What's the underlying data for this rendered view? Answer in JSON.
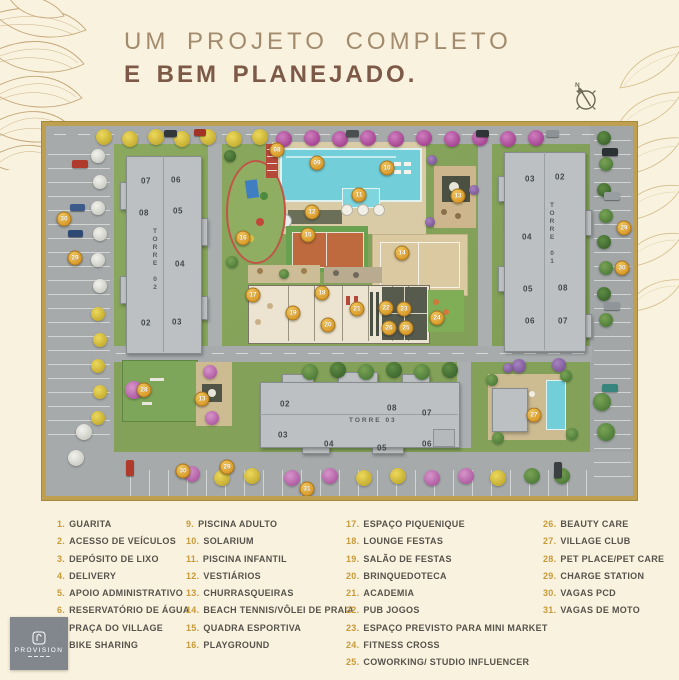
{
  "title": {
    "line1": "UM PROJETO COMPLETO",
    "line2": "E BEM PLANEJADO."
  },
  "compass": {
    "north_label": "N"
  },
  "watermark": {
    "text": "PROVISION"
  },
  "colors": {
    "accent_gold": "#bfa050",
    "marker": "#d99a2b",
    "title_light": "#a38b6e",
    "title_dark": "#7d5948",
    "grass": "#8aa75e",
    "road": "#a6aaab",
    "pool": "#72ced8",
    "legend_number": "#c79a3a",
    "legend_text": "#56524c"
  },
  "map": {
    "tower_labels": [
      {
        "text": "TORRE 02",
        "x": 109,
        "y": 102,
        "vertical": true
      },
      {
        "text": "TORRE 01",
        "x": 506,
        "y": 76,
        "vertical": true
      },
      {
        "text": "TORRE 03",
        "x": 303,
        "y": 291,
        "vertical": false
      }
    ],
    "unit_labels": [
      {
        "text": "07",
        "x": 100,
        "y": 55
      },
      {
        "text": "06",
        "x": 130,
        "y": 54
      },
      {
        "text": "08",
        "x": 98,
        "y": 87
      },
      {
        "text": "05",
        "x": 132,
        "y": 85
      },
      {
        "text": "04",
        "x": 134,
        "y": 138
      },
      {
        "text": "02",
        "x": 100,
        "y": 197
      },
      {
        "text": "03",
        "x": 131,
        "y": 196
      },
      {
        "text": "03",
        "x": 484,
        "y": 53
      },
      {
        "text": "02",
        "x": 514,
        "y": 51
      },
      {
        "text": "04",
        "x": 481,
        "y": 111
      },
      {
        "text": "05",
        "x": 482,
        "y": 163
      },
      {
        "text": "08",
        "x": 517,
        "y": 162
      },
      {
        "text": "06",
        "x": 484,
        "y": 195
      },
      {
        "text": "07",
        "x": 517,
        "y": 195
      },
      {
        "text": "02",
        "x": 239,
        "y": 278
      },
      {
        "text": "03",
        "x": 237,
        "y": 309
      },
      {
        "text": "04",
        "x": 283,
        "y": 318
      },
      {
        "text": "05",
        "x": 336,
        "y": 322
      },
      {
        "text": "06",
        "x": 381,
        "y": 318
      },
      {
        "text": "07",
        "x": 381,
        "y": 287
      },
      {
        "text": "08",
        "x": 346,
        "y": 282
      }
    ],
    "markers": [
      {
        "n": "08",
        "x": 231,
        "y": 24
      },
      {
        "n": "09",
        "x": 271,
        "y": 37
      },
      {
        "n": "10",
        "x": 341,
        "y": 42
      },
      {
        "n": "11",
        "x": 313,
        "y": 69
      },
      {
        "n": "12",
        "x": 266,
        "y": 86
      },
      {
        "n": "13",
        "x": 412,
        "y": 70
      },
      {
        "n": "14",
        "x": 356,
        "y": 127
      },
      {
        "n": "15",
        "x": 262,
        "y": 109
      },
      {
        "n": "16",
        "x": 197,
        "y": 112
      },
      {
        "n": "17",
        "x": 207,
        "y": 169
      },
      {
        "n": "18",
        "x": 276,
        "y": 167
      },
      {
        "n": "19",
        "x": 247,
        "y": 187
      },
      {
        "n": "20",
        "x": 282,
        "y": 199
      },
      {
        "n": "21",
        "x": 311,
        "y": 183
      },
      {
        "n": "22",
        "x": 340,
        "y": 182
      },
      {
        "n": "23",
        "x": 358,
        "y": 183
      },
      {
        "n": "26",
        "x": 343,
        "y": 202
      },
      {
        "n": "25",
        "x": 360,
        "y": 202
      },
      {
        "n": "24",
        "x": 391,
        "y": 192
      },
      {
        "n": "27",
        "x": 488,
        "y": 289
      },
      {
        "n": "28",
        "x": 98,
        "y": 264
      },
      {
        "n": "13",
        "x": 156,
        "y": 273
      },
      {
        "n": "29",
        "x": 29,
        "y": 132
      },
      {
        "n": "30",
        "x": 18,
        "y": 93
      },
      {
        "n": "29",
        "x": 181,
        "y": 341
      },
      {
        "n": "30",
        "x": 137,
        "y": 345
      },
      {
        "n": "31",
        "x": 261,
        "y": 363
      },
      {
        "n": "29",
        "x": 578,
        "y": 102
      },
      {
        "n": "30",
        "x": 576,
        "y": 142
      }
    ]
  },
  "legend": {
    "columns": [
      [
        {
          "n": "1.",
          "label": "GUARITA"
        },
        {
          "n": "2.",
          "label": "ACESSO DE VEÍCULOS"
        },
        {
          "n": "3.",
          "label": "DEPÓSITO DE LIXO"
        },
        {
          "n": "4.",
          "label": "DELIVERY"
        },
        {
          "n": "5.",
          "label": "APOIO ADMINISTRATIVO"
        },
        {
          "n": "6.",
          "label": "RESERVATÓRIO DE ÁGUA"
        },
        {
          "n": "7.",
          "label": "PRAÇA DO VILLAGE"
        },
        {
          "n": "8.",
          "label": "BIKE SHARING"
        }
      ],
      [
        {
          "n": "9.",
          "label": "PISCINA ADULTO"
        },
        {
          "n": "10.",
          "label": "SOLARIUM"
        },
        {
          "n": "11.",
          "label": "PISCINA INFANTIL"
        },
        {
          "n": "12.",
          "label": "VESTIÁRIOS"
        },
        {
          "n": "13.",
          "label": "CHURRASQUEIRAS"
        },
        {
          "n": "14.",
          "label": "BEACH TENNIS/VÔLEI DE PRAIA"
        },
        {
          "n": "15.",
          "label": "QUADRA ESPORTIVA"
        },
        {
          "n": "16.",
          "label": "PLAYGROUND"
        }
      ],
      [
        {
          "n": "17.",
          "label": "ESPAÇO PIQUENIQUE"
        },
        {
          "n": "18.",
          "label": "LOUNGE FESTAS"
        },
        {
          "n": "19.",
          "label": "SALÃO DE FESTAS"
        },
        {
          "n": "20.",
          "label": "BRINQUEDOTECA"
        },
        {
          "n": "21.",
          "label": "ACADEMIA"
        },
        {
          "n": "22.",
          "label": "PUB JOGOS"
        },
        {
          "n": "23.",
          "label": "ESPAÇO PREVISTO PARA MINI MARKET"
        },
        {
          "n": "24.",
          "label": "FITNESS CROSS"
        },
        {
          "n": "25.",
          "label": "COWORKING/ STUDIO INFLUENCER"
        }
      ],
      [
        {
          "n": "26.",
          "label": "BEAUTY CARE"
        },
        {
          "n": "27.",
          "label": "VILLAGE CLUB"
        },
        {
          "n": "28.",
          "label": "PET PLACE/PET CARE"
        },
        {
          "n": "29.",
          "label": "CHARGE STATION"
        },
        {
          "n": "30.",
          "label": "VAGAS PCD"
        },
        {
          "n": "31.",
          "label": "VAGAS DE MOTO"
        }
      ]
    ]
  }
}
